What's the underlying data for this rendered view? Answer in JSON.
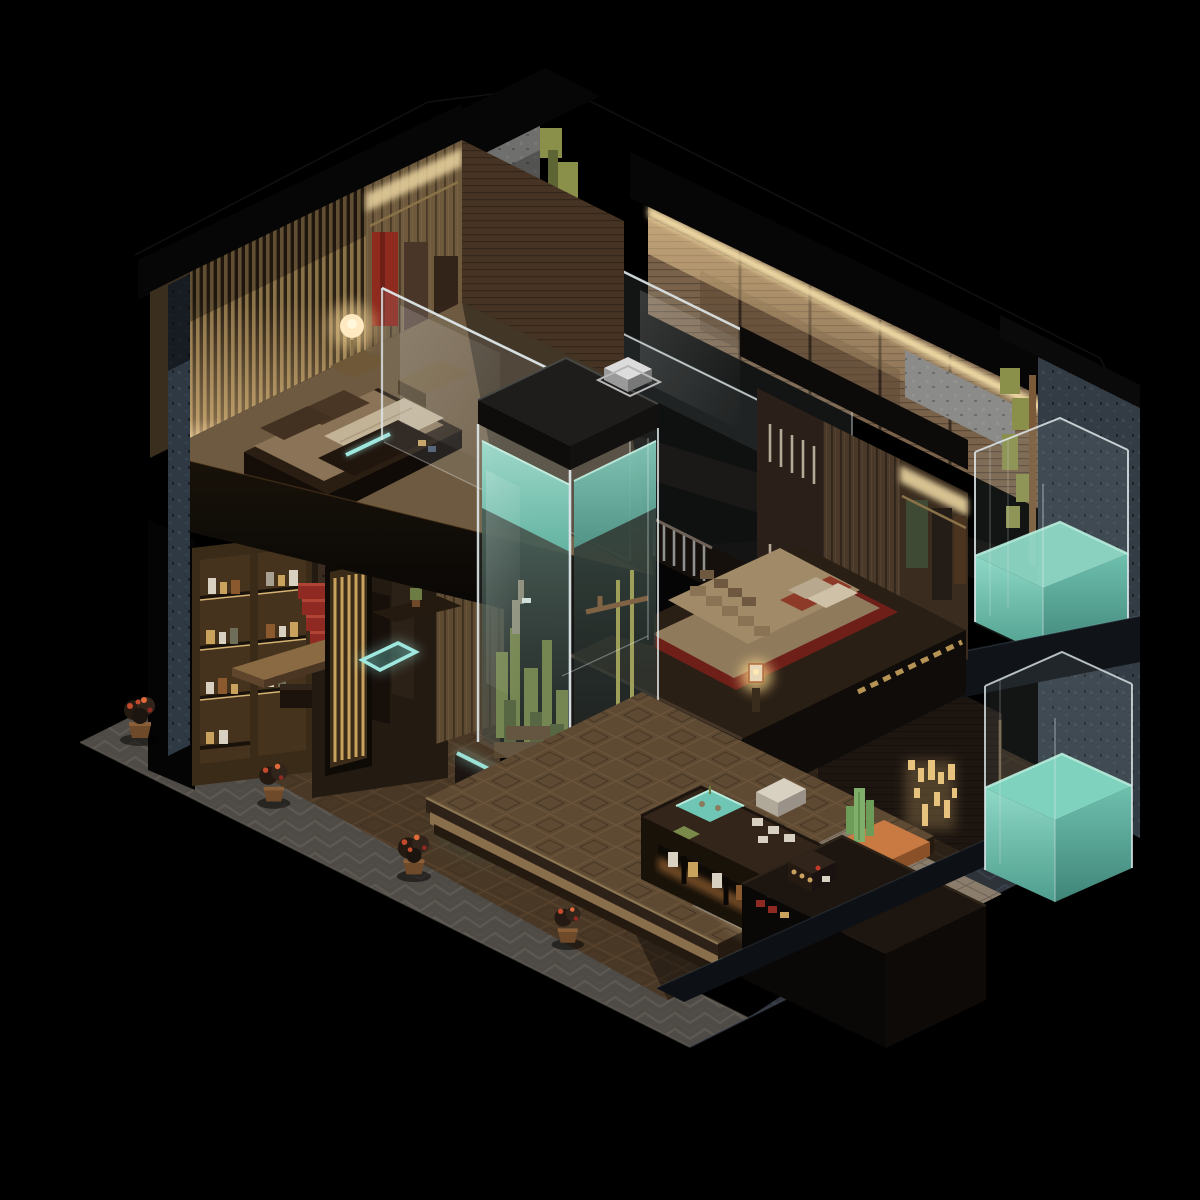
{
  "meta": {
    "background": "#000000",
    "style": "isometric voxel-art render, night lighting",
    "subject": "Two-story Japanese ryokan-style interior cutaway with central aquarium column"
  },
  "colors": {
    "background": "#000000",
    "outer_wall_blue": "#2f3944",
    "outer_wall_right": "#333b44",
    "stone_wall": "#6f706d",
    "roof_black": "#070606",
    "slat_light": "#8a7248",
    "slat_dark": "#2b2014",
    "alcove_wall": "#6e593c",
    "corridor_wall": "#7a624a",
    "led_strip": "#f2dca6",
    "moss_green": "#8a8f4a",
    "wall_wood_dark": "#2a2019",
    "wall_wood_dim": "#4a3928",
    "wardrobe_wall": "#3a2c1e",
    "glass_edge": "#dfe8ea",
    "water_teal_bright": "#8ed8c6",
    "water_teal": "#57b3a0",
    "water_teal_deep": "#3f8578",
    "aquarium_cap": "#1f1d1b",
    "silver_box": "#dcdcdc",
    "plant_green": "#6d7c42",
    "bamboo": "#9a9a4e",
    "driftwood": "#7a5a38",
    "base_wood": "#1c1410",
    "red_panel": "#7e231c",
    "glow_cyan": "#9fe8df",
    "bedroom_floor": "#6e5a40",
    "bed_platform": "#2a1e13",
    "mattress": "#8a7356",
    "pillow_brown": "#4a3624",
    "blanket_white": "#c2b296",
    "bed2_blanket": "#a08a68",
    "bed2_red": "#6e1f18",
    "bed2_pillow": "#cfc0a8",
    "lamp_warm": "#ffe9c0",
    "shelf_wood": "#3a2a18",
    "bottle_white": "#d8d0c0",
    "bottle_amber": "#c9a25e",
    "bottle_brown": "#8a5a2e",
    "stairs_red": "#8e2a22",
    "door_gold": "#c9a25e",
    "floor_wood": "#4a3826",
    "tatami": "#5e4a33",
    "counter_top": "#33251a",
    "basin_teal": "#6fc6b4",
    "cup_white": "#d8d0c0",
    "desk_top": "#1c1510",
    "tile_pale": "#8a7d6c",
    "copper": "#b06a3a",
    "cactus": "#7fae6a",
    "gold_light": "#e8c37e",
    "walkway_gray": "#4e4a45",
    "walkway_dark": "#2e333a",
    "pot_brown": "#6e4a2a",
    "flower_red": "#c44a2e",
    "underglow": "#b4763a"
  },
  "scene": {
    "upper_floor": {
      "rooms": [
        {
          "name": "bedroom-upper-left",
          "contents": "slatted wood wall, platform bed with brown pillows and white throw, glowing globe lamp, hanging red and brown garments, glass balustrade"
        },
        {
          "name": "corridor-upper",
          "contents": "wood mosaic wall with warm LED cove strip, glass railing over void"
        },
        {
          "name": "stairwell",
          "contents": "gray stone wall with climbing moss, glass screen, stair balusters"
        },
        {
          "name": "bedroom-upper-right",
          "contents": "cantilevered black platform, voxel-stepped tan blanket over red mat, pillows, candle lantern, lit wardrobe with hanging clothes, warm underglow"
        },
        {
          "name": "upper-bath",
          "contents": "rounded glass tank half-filled with teal water, moss wall, brass pipe"
        }
      ]
    },
    "ground_floor": {
      "rooms": [
        {
          "name": "bar-lounge",
          "contents": "backlit shelf unit with bottles and jars, live-edge wood table, red staircase, gold slatted door"
        },
        {
          "name": "tea-room",
          "contents": "teal glowing floor square, low table with plant, vertical strip wall"
        },
        {
          "name": "reception",
          "contents": "tatami platform with diamond weave, tea counter with teal basin and cups, lit jar niche, black reception desk with espresso machine"
        },
        {
          "name": "bathroom",
          "contents": "pale stone tiles with floor lamp glow, white sink blocks, cactus in copper trough, gold trickle wall light, glass tub of teal water"
        }
      ]
    },
    "objects": [
      {
        "name": "aquarium-column",
        "desc": "full-height glass aquarium, teal water, coral towers, bamboo, driftwood, dark cap with silver box, red base with cyan neon strip"
      },
      {
        "name": "candle-lanterns",
        "desc": "two copper candle lanterns at aquarium base"
      },
      {
        "name": "walkway",
        "desc": "gray chevron-patterned stone path around two street edges"
      },
      {
        "name": "potted-plants",
        "desc": "four dark shrubs with red-orange blossoms in wooden pots"
      }
    ]
  }
}
